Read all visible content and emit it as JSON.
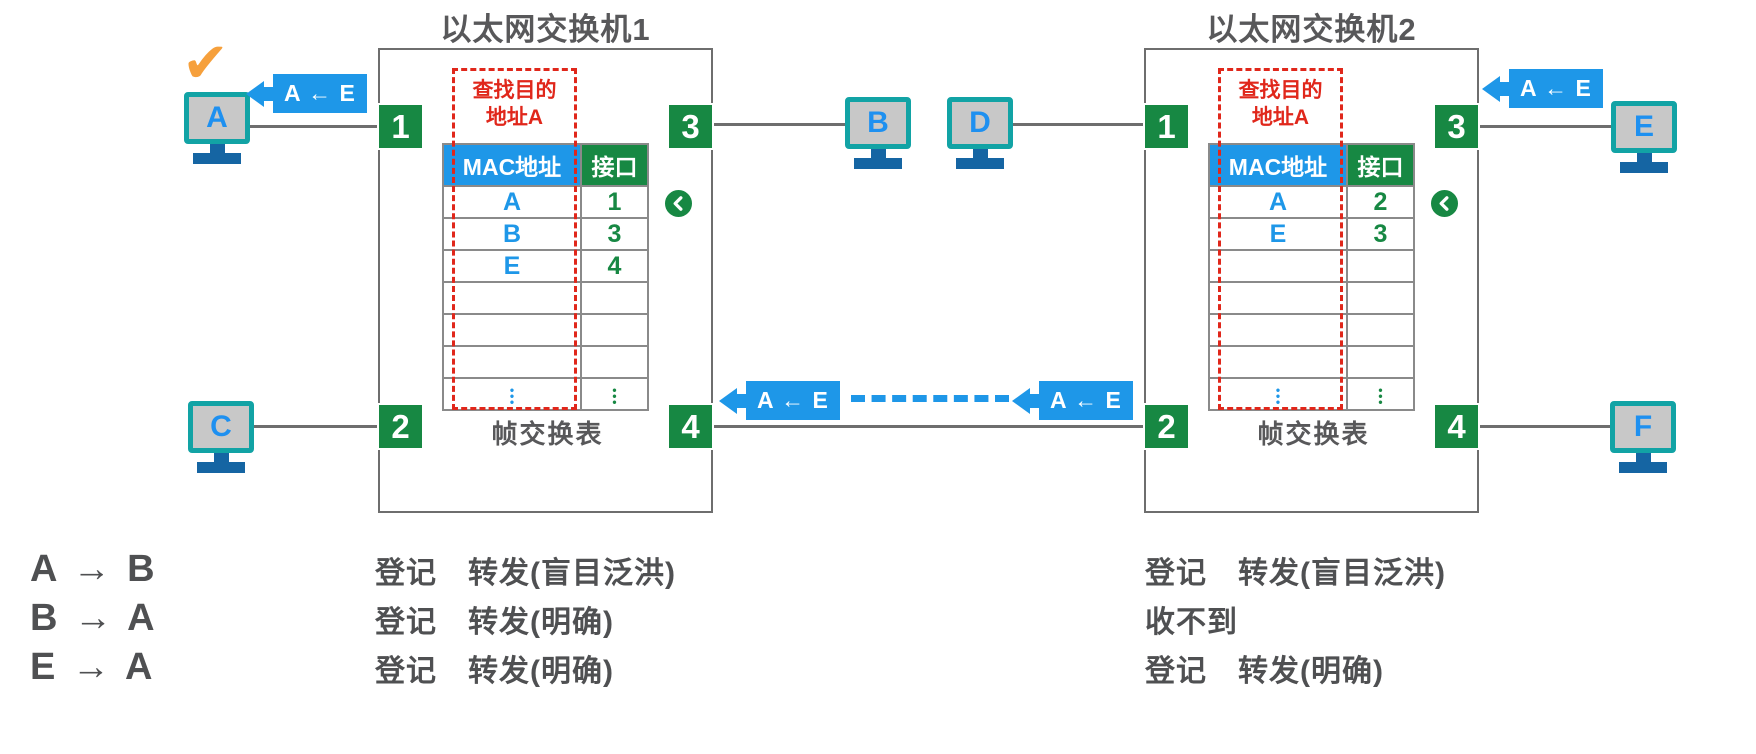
{
  "switches": [
    {
      "title": "以太网交换机1",
      "lookup": [
        "查找目的",
        "地址A"
      ],
      "table": {
        "headers": [
          "MAC地址",
          "接口"
        ],
        "rows": [
          [
            "A",
            "1"
          ],
          [
            "B",
            "3"
          ],
          [
            "E",
            "4"
          ],
          [
            "",
            ""
          ],
          [
            "",
            ""
          ],
          [
            "",
            ""
          ],
          [
            "•\n•\n•",
            "•\n•\n•"
          ]
        ]
      },
      "caption": "帧交换表",
      "ports": [
        "1",
        "2",
        "3",
        "4"
      ]
    },
    {
      "title": "以太网交换机2",
      "lookup": [
        "查找目的",
        "地址A"
      ],
      "table": {
        "headers": [
          "MAC地址",
          "接口"
        ],
        "rows": [
          [
            "A",
            "2"
          ],
          [
            "E",
            "3"
          ],
          [
            "",
            ""
          ],
          [
            "",
            ""
          ],
          [
            "",
            ""
          ],
          [
            "",
            ""
          ],
          [
            "•\n•\n•",
            "•\n•\n•"
          ]
        ]
      },
      "caption": "帧交换表",
      "ports": [
        "1",
        "2",
        "3",
        "4"
      ]
    }
  ],
  "hosts": [
    {
      "label": "A"
    },
    {
      "label": "B"
    },
    {
      "label": "C"
    },
    {
      "label": "D"
    },
    {
      "label": "E"
    },
    {
      "label": "F"
    }
  ],
  "frames": [
    {
      "label": "A ← E"
    },
    {
      "label": "A ← E"
    },
    {
      "label": "A ← E"
    },
    {
      "label": "A ← E"
    }
  ],
  "check_icon": "✔",
  "annotations": {
    "rows": [
      {
        "flow": "A → B",
        "switch1": "登记　转发(盲目泛洪)",
        "switch2": "登记　转发(盲目泛洪)"
      },
      {
        "flow": "B → A",
        "switch1": "登记　转发(明确)",
        "switch2": "收不到"
      },
      {
        "flow": "E → A",
        "switch1": "登记　转发(明确)",
        "switch2": "登记　转发(明确)"
      }
    ]
  },
  "colors": {
    "accent_blue": "#1E97E8",
    "port_green": "#178843",
    "alert_red": "#E0271B",
    "check_orange": "#F6A03C",
    "host_teal": "#12A3A5",
    "host_stand_blue": "#1565A3",
    "text_gray": "#58585A"
  }
}
